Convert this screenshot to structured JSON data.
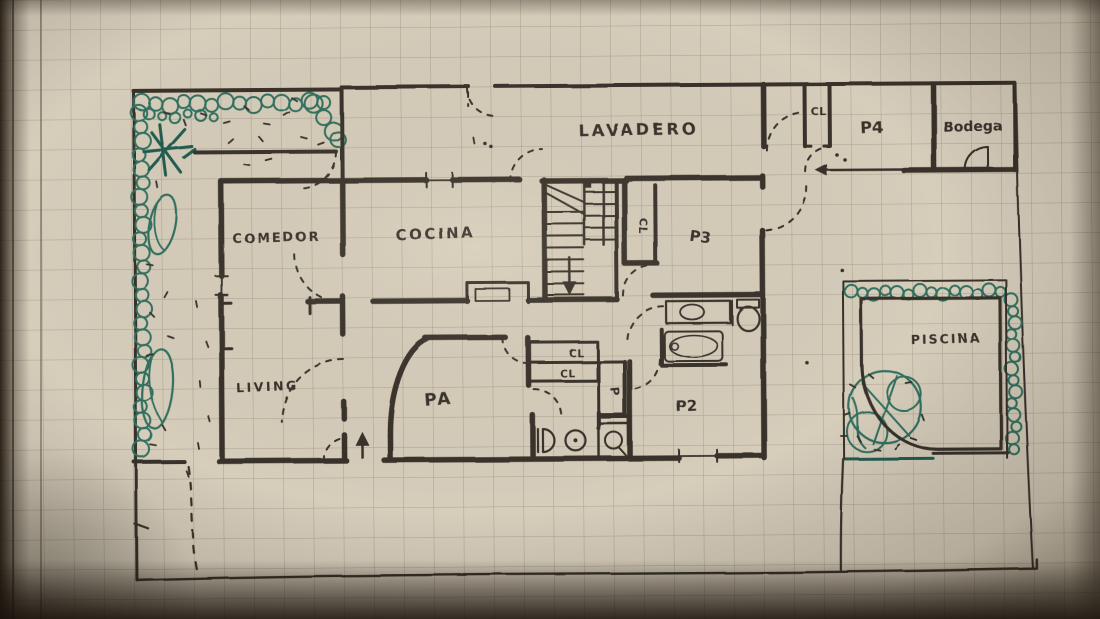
{
  "rooms": [
    {
      "id": "lavadero",
      "label": "LAVADERO"
    },
    {
      "id": "p4-closet",
      "label": "CL"
    },
    {
      "id": "p4",
      "label": "P4"
    },
    {
      "id": "bodega",
      "label": "Bodega"
    },
    {
      "id": "comedor",
      "label": "COMEDOR"
    },
    {
      "id": "cocina",
      "label": "COCINA"
    },
    {
      "id": "stair-closet",
      "label": "CL"
    },
    {
      "id": "p3",
      "label": "P3"
    },
    {
      "id": "living",
      "label": "LIVING"
    },
    {
      "id": "pa",
      "label": "PA"
    },
    {
      "id": "closet-1",
      "label": "CL"
    },
    {
      "id": "closet-2",
      "label": "CL"
    },
    {
      "id": "p-small",
      "label": "P"
    },
    {
      "id": "p2",
      "label": "P2"
    },
    {
      "id": "piscina",
      "label": "PISCINA"
    }
  ],
  "colors": {
    "ink": "#37312a",
    "plant_green": "#33705f",
    "plant_dark": "#205c50",
    "paper": "#d6cdbb",
    "grid_line": "#7e7361"
  }
}
